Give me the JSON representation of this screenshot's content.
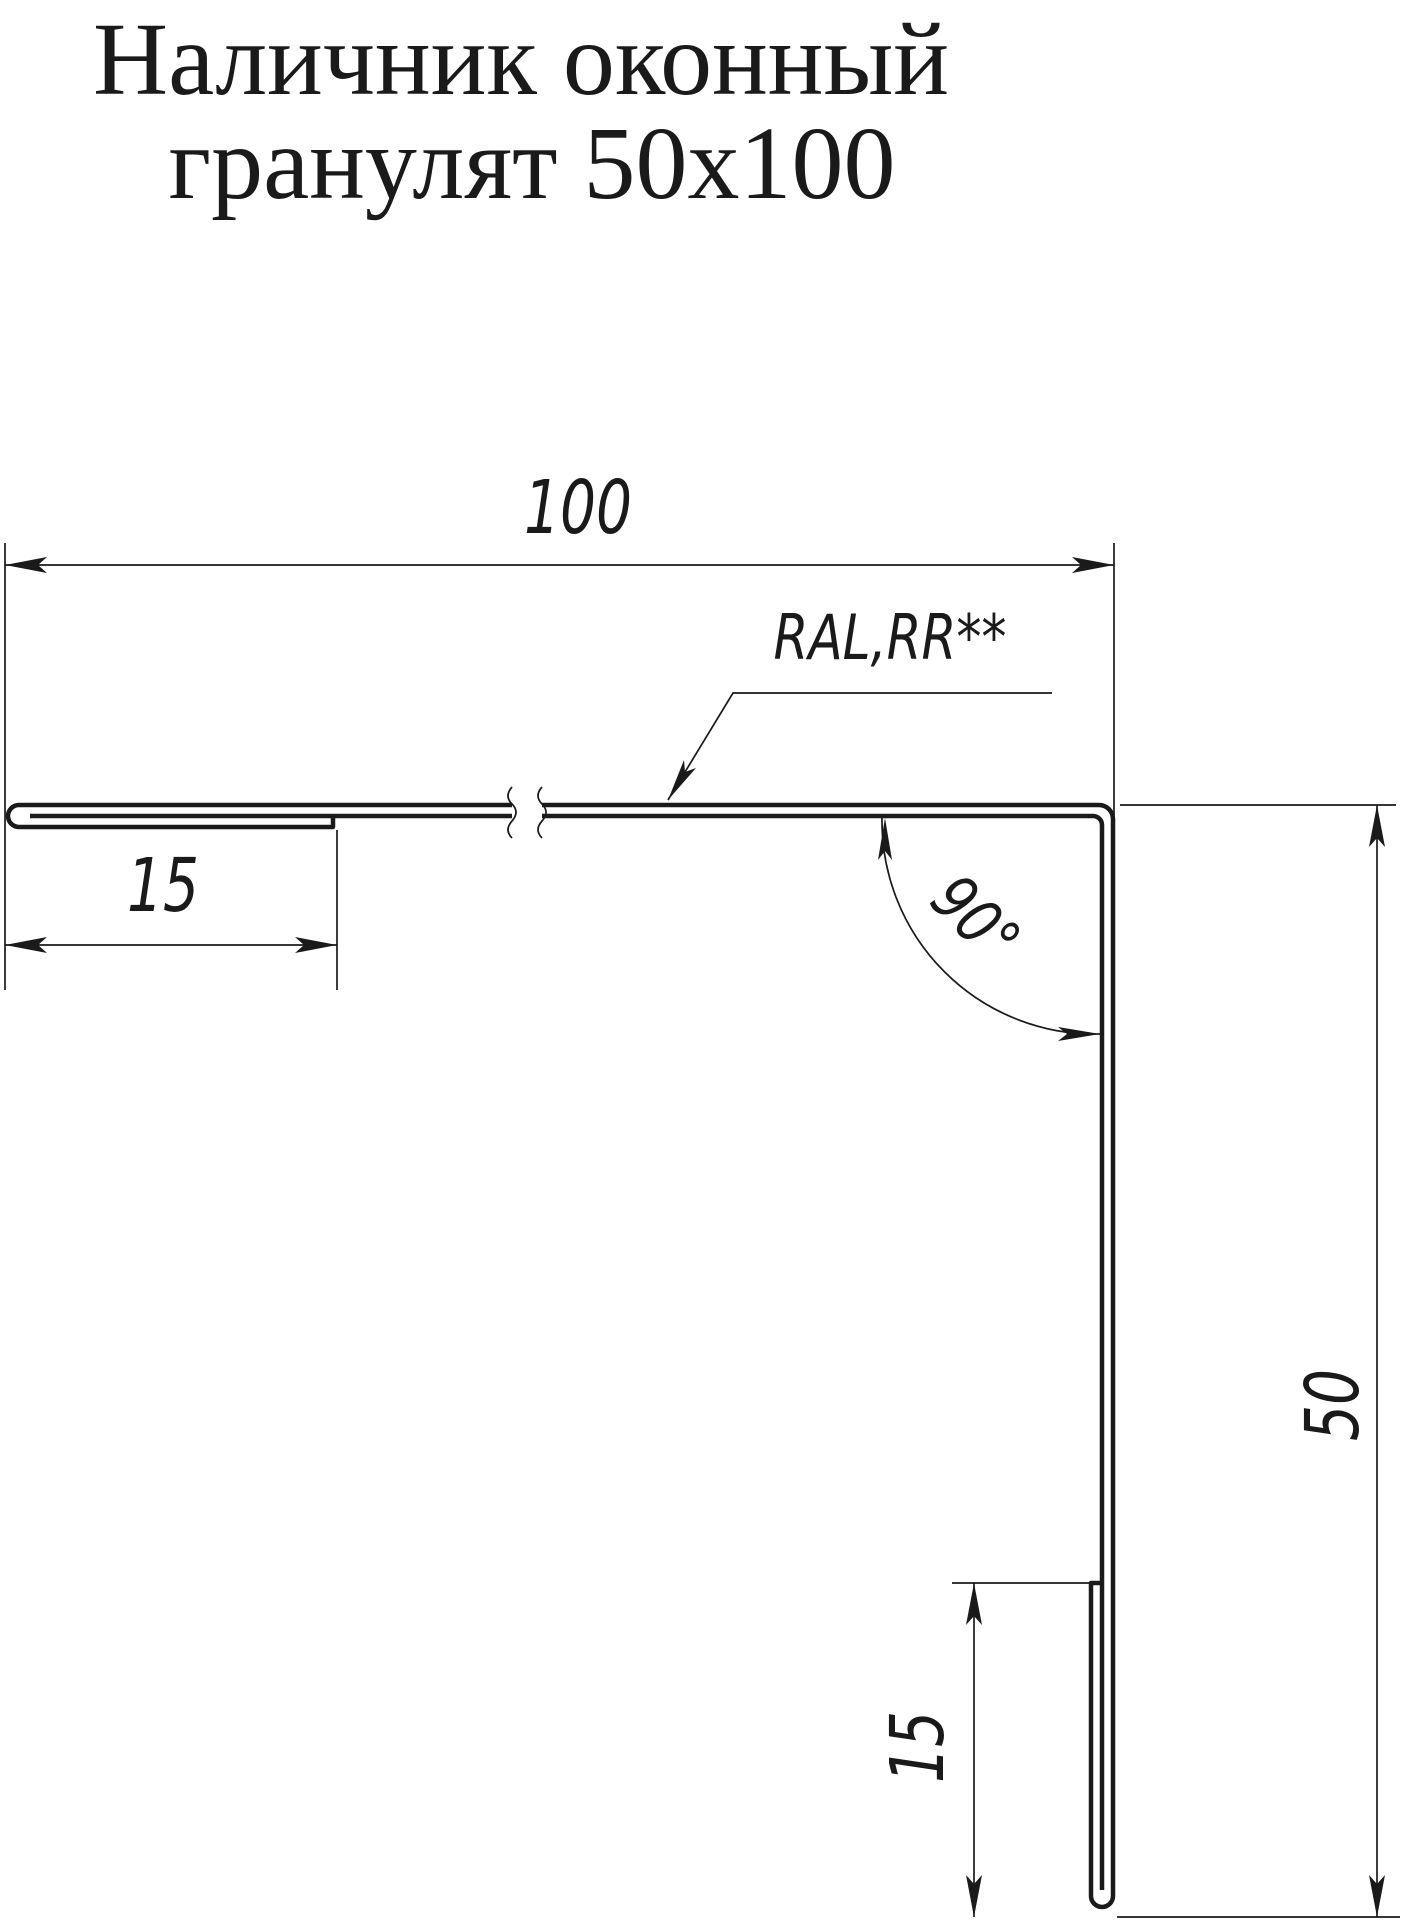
{
  "title": {
    "line1": "Наличник оконный",
    "line2": "гранулят 50х100"
  },
  "dimensions": {
    "width_top": "100",
    "hem_left": "15",
    "material": "RAL,RR**",
    "angle": "90°",
    "height_right": "50",
    "hem_bottom": "15"
  },
  "colors": {
    "ink": "#1a1a1a",
    "background": "#ffffff"
  }
}
